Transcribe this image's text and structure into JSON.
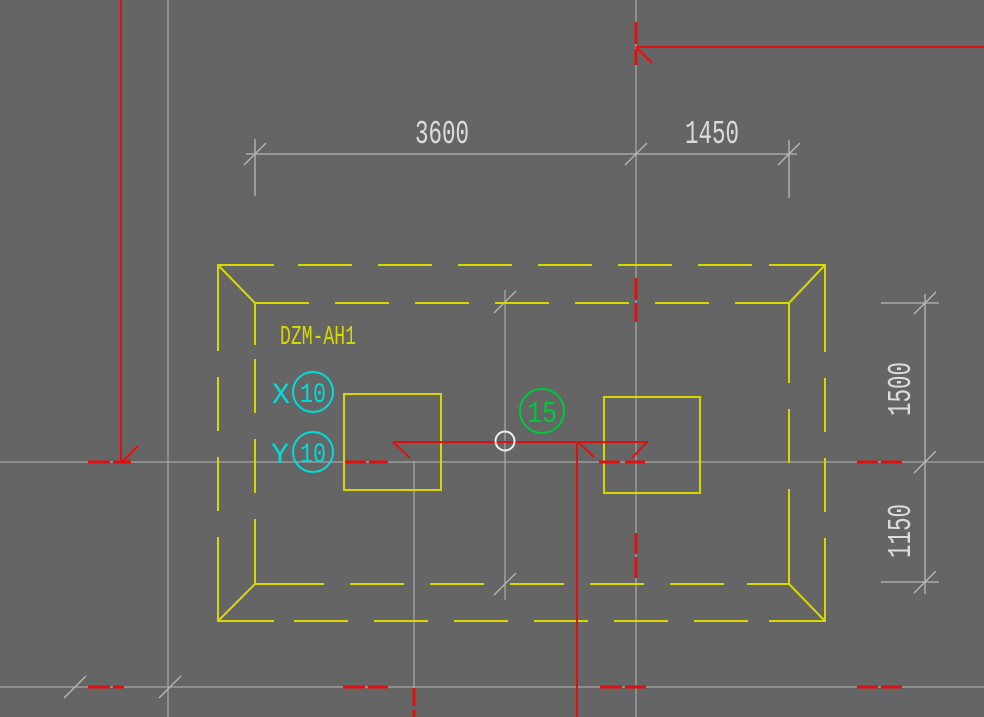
{
  "drawing": {
    "label": "DZM-AH1",
    "section_label": "15",
    "axis_x": {
      "letter": "X",
      "value": "10"
    },
    "axis_y": {
      "letter": "Y",
      "value": "10"
    },
    "dimensions": {
      "top": [
        "3600",
        "1450"
      ],
      "right": [
        "1500",
        "1150"
      ]
    },
    "colors": {
      "background": "#656565",
      "grid_line": "#a6a6a6",
      "dimension_text": "#dcdcdc",
      "foundation_yellow": "#d8d800",
      "section_red": "#e01010",
      "axis_cyan": "#00dcdc",
      "detail_green": "#00c83c",
      "marker_white": "#f0f0f0"
    }
  }
}
